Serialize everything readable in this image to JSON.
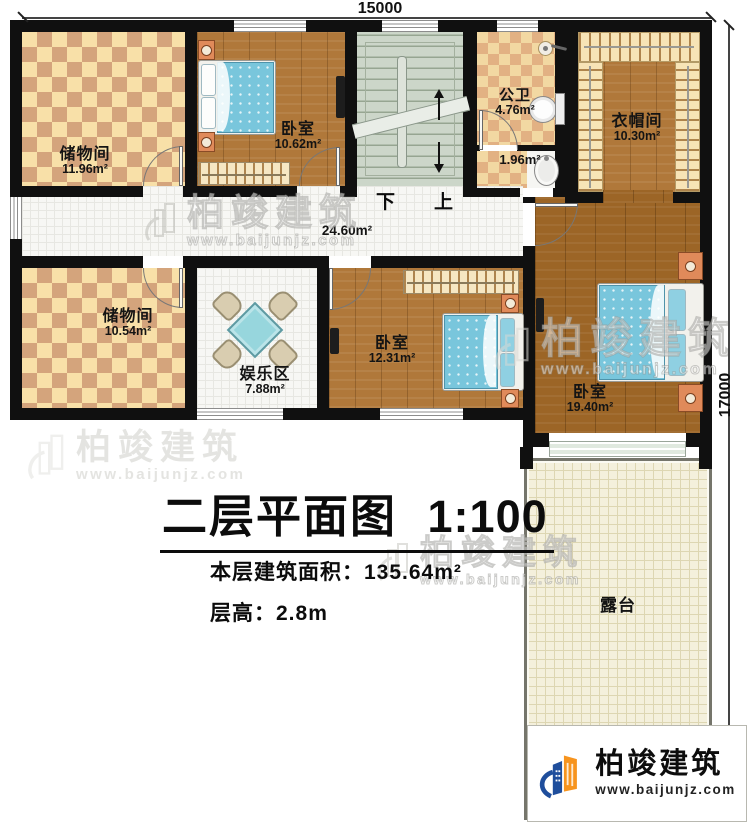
{
  "dimensions": {
    "top": "15000",
    "right": "17000"
  },
  "rooms": {
    "storage_top": {
      "name": "储物间",
      "area": "11.96m²"
    },
    "bedroom_top": {
      "name": "卧室",
      "area": "10.62m²"
    },
    "bath": {
      "name": "公卫",
      "area": "4.76m²"
    },
    "wash": {
      "area": "1.96m²"
    },
    "cloak": {
      "name": "衣帽间",
      "area": "10.30m²"
    },
    "hall": {
      "area": "24.60m²"
    },
    "storage_bottom": {
      "name": "储物间",
      "area": "10.54m²"
    },
    "play": {
      "name": "娱乐区",
      "area": "7.88m²"
    },
    "bedroom_mid": {
      "name": "卧室",
      "area": "12.31m²"
    },
    "bedroom_master": {
      "name": "卧室",
      "area": "19.40m²"
    },
    "terrace": {
      "name": "露台"
    }
  },
  "stairs": {
    "down": "下",
    "up": "上"
  },
  "title": {
    "main": "二层平面图",
    "scale": "1:100",
    "area_label": "本层建筑面积：",
    "area_value": "135.64m²",
    "floor_height_label": "层高：",
    "floor_height_value": "2.8m"
  },
  "brand": {
    "name": "柏竣建筑",
    "url": "www.baijunjz.com"
  },
  "colors": {
    "wall": "#101010",
    "wood": "#b0783a",
    "wood_dark": "#9c6526",
    "checker_light": "#f8e0a8",
    "checker_dark": "#d4a47c",
    "stair": "#ccd6c9",
    "mattress": "#79c6dc",
    "brand_blue": "#1f4e9c",
    "brand_orange": "#f7941e"
  }
}
